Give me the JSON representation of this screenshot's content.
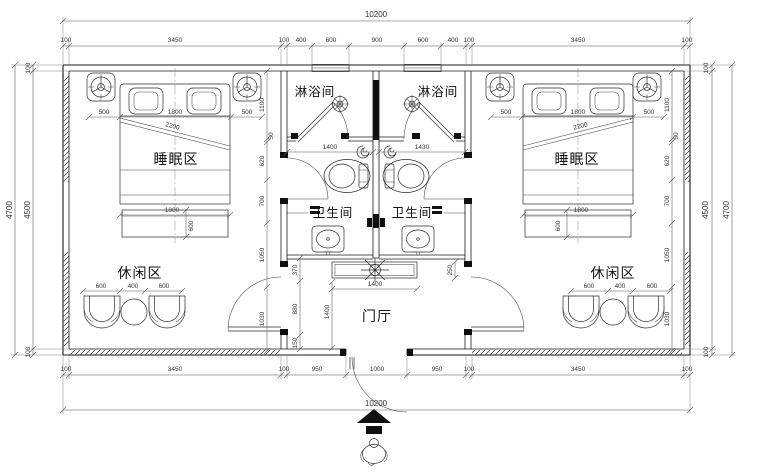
{
  "drawing": {
    "type": "architectural-floor-plan",
    "units": "mm"
  },
  "rooms": {
    "shower_left": "淋浴间",
    "shower_right": "淋浴间",
    "wc_left": "卫生间",
    "wc_right": "卫生间",
    "sleep_left": "睡眠区",
    "sleep_right": "睡眠区",
    "leisure_left": "休闲区",
    "leisure_right": "休闲区",
    "foyer": "门厅"
  },
  "dims": {
    "top_overall": "10200",
    "top_segments": [
      "100",
      "3450",
      "100",
      "400",
      "600",
      "900",
      "600",
      "400",
      "100",
      "3450",
      "100"
    ],
    "bottom_segments": [
      "100",
      "3450",
      "100",
      "950",
      "1000",
      "950",
      "100",
      "3450",
      "100"
    ],
    "bottom_overall": "10200",
    "left_outer": "4700",
    "left_chain": [
      "100",
      "4500",
      "100"
    ],
    "right_outer": "4700",
    "right_chain": [
      "100",
      "4500",
      "100"
    ],
    "bed_left_top": [
      "500",
      "1800",
      "500"
    ],
    "bed_right_top": [
      "500",
      "1800",
      "500"
    ],
    "side_chain_left": [
      "1100",
      "50",
      "620",
      "700",
      "1050",
      "1030"
    ],
    "side_chain_right": [
      "1100",
      "50",
      "620",
      "700",
      "1050",
      "1030"
    ],
    "bed_diag_left": "2200",
    "bed_diag_right": "2200",
    "underbed_left": [
      "1800",
      "600"
    ],
    "underbed_right": [
      "1800",
      "600"
    ],
    "leisure_left": [
      "600",
      "400",
      "600"
    ],
    "leisure_right": [
      "600",
      "400",
      "600"
    ],
    "bath_left_width": "1400",
    "bath_right_width": "1430",
    "foyer_chain": [
      "370",
      "880",
      "150"
    ],
    "foyer_height": "1400",
    "counter_width": "1400",
    "counter_depth": "250"
  },
  "symbols": {
    "ceiling_lamp": "ceiling-lamp-icon",
    "floor_drain": "floor-drain-icon",
    "spiral_vent": "spiral-vent-icon",
    "ceiling_fan": "ceiling-fan-icon",
    "toilet": "toilet-icon",
    "sink": "sink-icon",
    "armchair": "armchair-icon",
    "entry_arrow": "entry-direction-arrow",
    "person": "person-figure"
  },
  "colors": {
    "line": "#1a1a1a",
    "dim": "#444444",
    "bg": "#ffffff"
  }
}
